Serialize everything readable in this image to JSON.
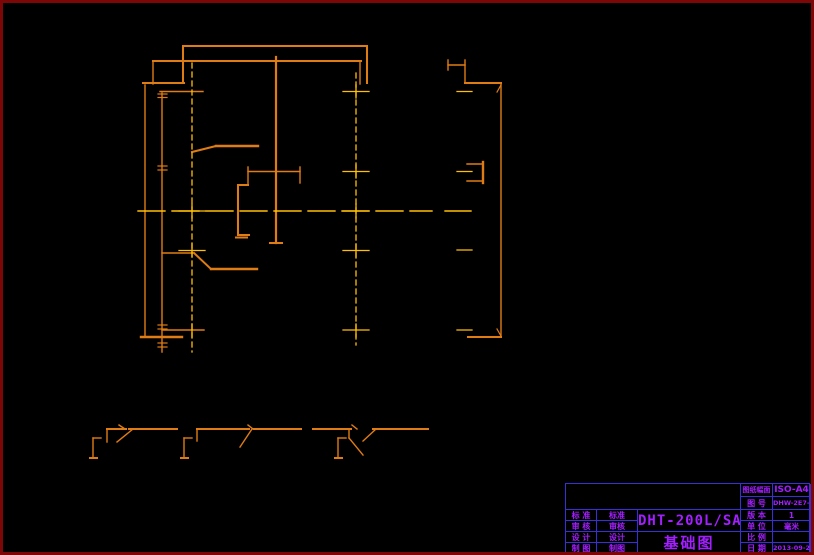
{
  "title_block": {
    "model": "DHT-200L/SA",
    "drawing_title": "基础图",
    "left_rows": [
      {
        "label": "标 准",
        "value": "标准"
      },
      {
        "label": "审 核",
        "value": "审核"
      },
      {
        "label": "设 计",
        "value": "设计"
      },
      {
        "label": "制 图",
        "value": "制图"
      }
    ],
    "right_rows": [
      {
        "label": "图纸幅面",
        "value": "ISO-A4"
      },
      {
        "label": "图 号",
        "value": "DHW-2E7-01"
      },
      {
        "label": "版 本",
        "value": "1"
      },
      {
        "label": "单 位",
        "value": "毫米"
      },
      {
        "label": "比 例",
        "value": ""
      },
      {
        "label": "日 期",
        "value": "2013-09-21"
      }
    ]
  },
  "drawing": {
    "colors": {
      "o": "#e07c14",
      "y": "#ffc003"
    },
    "segments": [
      [
        183,
        46,
        367,
        46,
        2,
        "o"
      ],
      [
        183,
        46,
        183,
        83,
        2,
        "o"
      ],
      [
        367,
        46,
        367,
        83,
        2,
        "o"
      ],
      [
        153,
        61,
        361,
        61,
        2,
        "o"
      ],
      [
        153,
        61,
        153,
        84,
        1.4,
        "o"
      ],
      [
        143,
        83,
        184,
        83,
        2,
        "o"
      ],
      [
        360,
        61,
        360,
        84,
        1.4,
        "o"
      ],
      [
        145,
        85,
        145,
        336,
        1.4,
        "o"
      ],
      [
        141,
        337,
        182,
        337,
        2.4,
        "o"
      ],
      [
        162,
        93,
        162,
        352,
        1.4,
        "o"
      ],
      [
        276,
        57,
        276,
        243,
        2.2,
        "o"
      ],
      [
        270,
        243,
        282,
        243,
        2,
        "o"
      ],
      [
        192,
        152,
        216,
        146,
        2,
        "o"
      ],
      [
        216,
        146,
        258,
        146,
        2.4,
        "o"
      ],
      [
        162,
        253,
        194,
        253,
        1.4,
        "o"
      ],
      [
        194,
        253,
        211,
        269,
        2,
        "o"
      ],
      [
        211,
        269,
        257,
        269,
        2.4,
        "o"
      ],
      [
        248,
        167,
        248,
        185,
        1.4,
        "o"
      ],
      [
        300,
        167,
        300,
        183,
        1.4,
        "o"
      ],
      [
        248,
        171.5,
        300,
        171.5,
        1.4,
        "o"
      ],
      [
        238,
        185,
        248,
        185,
        2,
        "o"
      ],
      [
        238,
        185,
        238,
        235,
        2,
        "o"
      ],
      [
        238,
        235,
        249,
        235,
        2,
        "o"
      ],
      [
        236,
        237.5,
        247,
        237.5,
        2,
        "o"
      ],
      [
        160,
        91.5,
        203,
        91.5,
        1.4,
        "o"
      ],
      [
        162,
        330,
        204,
        330,
        1.4,
        "o"
      ],
      [
        467,
        164,
        483,
        164,
        1.4,
        "o"
      ],
      [
        467,
        181,
        483,
        181,
        1.4,
        "o"
      ],
      [
        483,
        162,
        483,
        183,
        2.4,
        "o"
      ],
      [
        448,
        65,
        465,
        65,
        1.4,
        "o"
      ],
      [
        448,
        60,
        448,
        70,
        1.4,
        "o"
      ],
      [
        465,
        60,
        465,
        83,
        1.4,
        "o"
      ],
      [
        465,
        83,
        501,
        83,
        2,
        "o"
      ],
      [
        501,
        83,
        501,
        337,
        1.4,
        "o"
      ],
      [
        468,
        337,
        501,
        337,
        2,
        "o"
      ],
      [
        497,
        92,
        501,
        85,
        1.2,
        "o"
      ],
      [
        497,
        329,
        501,
        336,
        1.2,
        "o"
      ],
      [
        158,
        94,
        167,
        94,
        1.2,
        "o"
      ],
      [
        158,
        97.5,
        167,
        97.5,
        1.2,
        "o"
      ],
      [
        158,
        166,
        167,
        166,
        1.2,
        "o"
      ],
      [
        158,
        170,
        167,
        170,
        1.2,
        "o"
      ],
      [
        158,
        325,
        167,
        325,
        1.2,
        "o"
      ],
      [
        158,
        329,
        167,
        329,
        1.2,
        "o"
      ],
      [
        158,
        343,
        167,
        343,
        1.2,
        "o"
      ],
      [
        158,
        347,
        167,
        347,
        1.2,
        "o"
      ],
      [
        90,
        458,
        97,
        458,
        2,
        "o"
      ],
      [
        93,
        438,
        93,
        458,
        1.4,
        "o"
      ],
      [
        93,
        438,
        101,
        438,
        1.4,
        "o"
      ],
      [
        107,
        429,
        107,
        442,
        1.4,
        "o"
      ],
      [
        107,
        429,
        126,
        429,
        2,
        "o"
      ],
      [
        133,
        429,
        117,
        442,
        1.4,
        "o"
      ],
      [
        119,
        425,
        125,
        429,
        1.4,
        "o"
      ],
      [
        129,
        429,
        177,
        429,
        2,
        "o"
      ],
      [
        181,
        458,
        188,
        458,
        2,
        "o"
      ],
      [
        184,
        438,
        184,
        458,
        1.4,
        "o"
      ],
      [
        184,
        438,
        192,
        438,
        1.4,
        "o"
      ],
      [
        197,
        429,
        197,
        441,
        1.4,
        "o"
      ],
      [
        197,
        429,
        249,
        429,
        2,
        "o"
      ],
      [
        252,
        429,
        240,
        447,
        1.4,
        "o"
      ],
      [
        248,
        425,
        253,
        429,
        1.4,
        "o"
      ],
      [
        254,
        429,
        301,
        429,
        2,
        "o"
      ],
      [
        313,
        429,
        351,
        429,
        2,
        "o"
      ],
      [
        335,
        458,
        342,
        458,
        2,
        "o"
      ],
      [
        338,
        438,
        338,
        458,
        1.4,
        "o"
      ],
      [
        338,
        438,
        346,
        438,
        1.4,
        "o"
      ],
      [
        349,
        429,
        349,
        438,
        1.4,
        "o"
      ],
      [
        349,
        438,
        363,
        455,
        1.4,
        "o"
      ],
      [
        376,
        429,
        363,
        441,
        1.4,
        "o"
      ],
      [
        352,
        425,
        357,
        429,
        1.4,
        "o"
      ],
      [
        373,
        429,
        428,
        429,
        2,
        "o"
      ],
      [
        445,
        211,
        471,
        211,
        1.4,
        "y"
      ],
      [
        179,
        211,
        205,
        211,
        1.3,
        "y"
      ],
      [
        192,
        204,
        192,
        218,
        1.3,
        "y"
      ],
      [
        179,
        250.5,
        205,
        250.5,
        1.3,
        "y"
      ],
      [
        192,
        244,
        192,
        257,
        1.3,
        "y"
      ],
      [
        192,
        324,
        192,
        337,
        1.3,
        "y"
      ],
      [
        343,
        91.5,
        369,
        91.5,
        1.3,
        "y"
      ],
      [
        356,
        85,
        356,
        98,
        1.3,
        "y"
      ],
      [
        343,
        171.5,
        369,
        171.5,
        1.3,
        "y"
      ],
      [
        356,
        165,
        356,
        178,
        1.3,
        "y"
      ],
      [
        343,
        211,
        369,
        211,
        1.3,
        "y"
      ],
      [
        356,
        204,
        356,
        218,
        1.3,
        "y"
      ],
      [
        343,
        250.5,
        369,
        250.5,
        1.3,
        "y"
      ],
      [
        356,
        244,
        356,
        257,
        1.3,
        "y"
      ],
      [
        343,
        330,
        369,
        330,
        1.3,
        "y"
      ],
      [
        356,
        324,
        356,
        337,
        1.3,
        "y"
      ],
      [
        457,
        91.5,
        472,
        91.5,
        1.3,
        "y"
      ],
      [
        457,
        171.5,
        472,
        171.5,
        1.3,
        "y"
      ],
      [
        457,
        250,
        472,
        250,
        1.3,
        "y"
      ],
      [
        457,
        330,
        472,
        330,
        1.3,
        "y"
      ],
      [
        192,
        63,
        192,
        352,
        1.3,
        "y",
        "5 4"
      ],
      [
        356,
        73,
        356,
        345,
        1.3,
        "y",
        "5 4"
      ],
      [
        138,
        211,
        432,
        211,
        1.4,
        "y",
        "27 7"
      ]
    ]
  }
}
